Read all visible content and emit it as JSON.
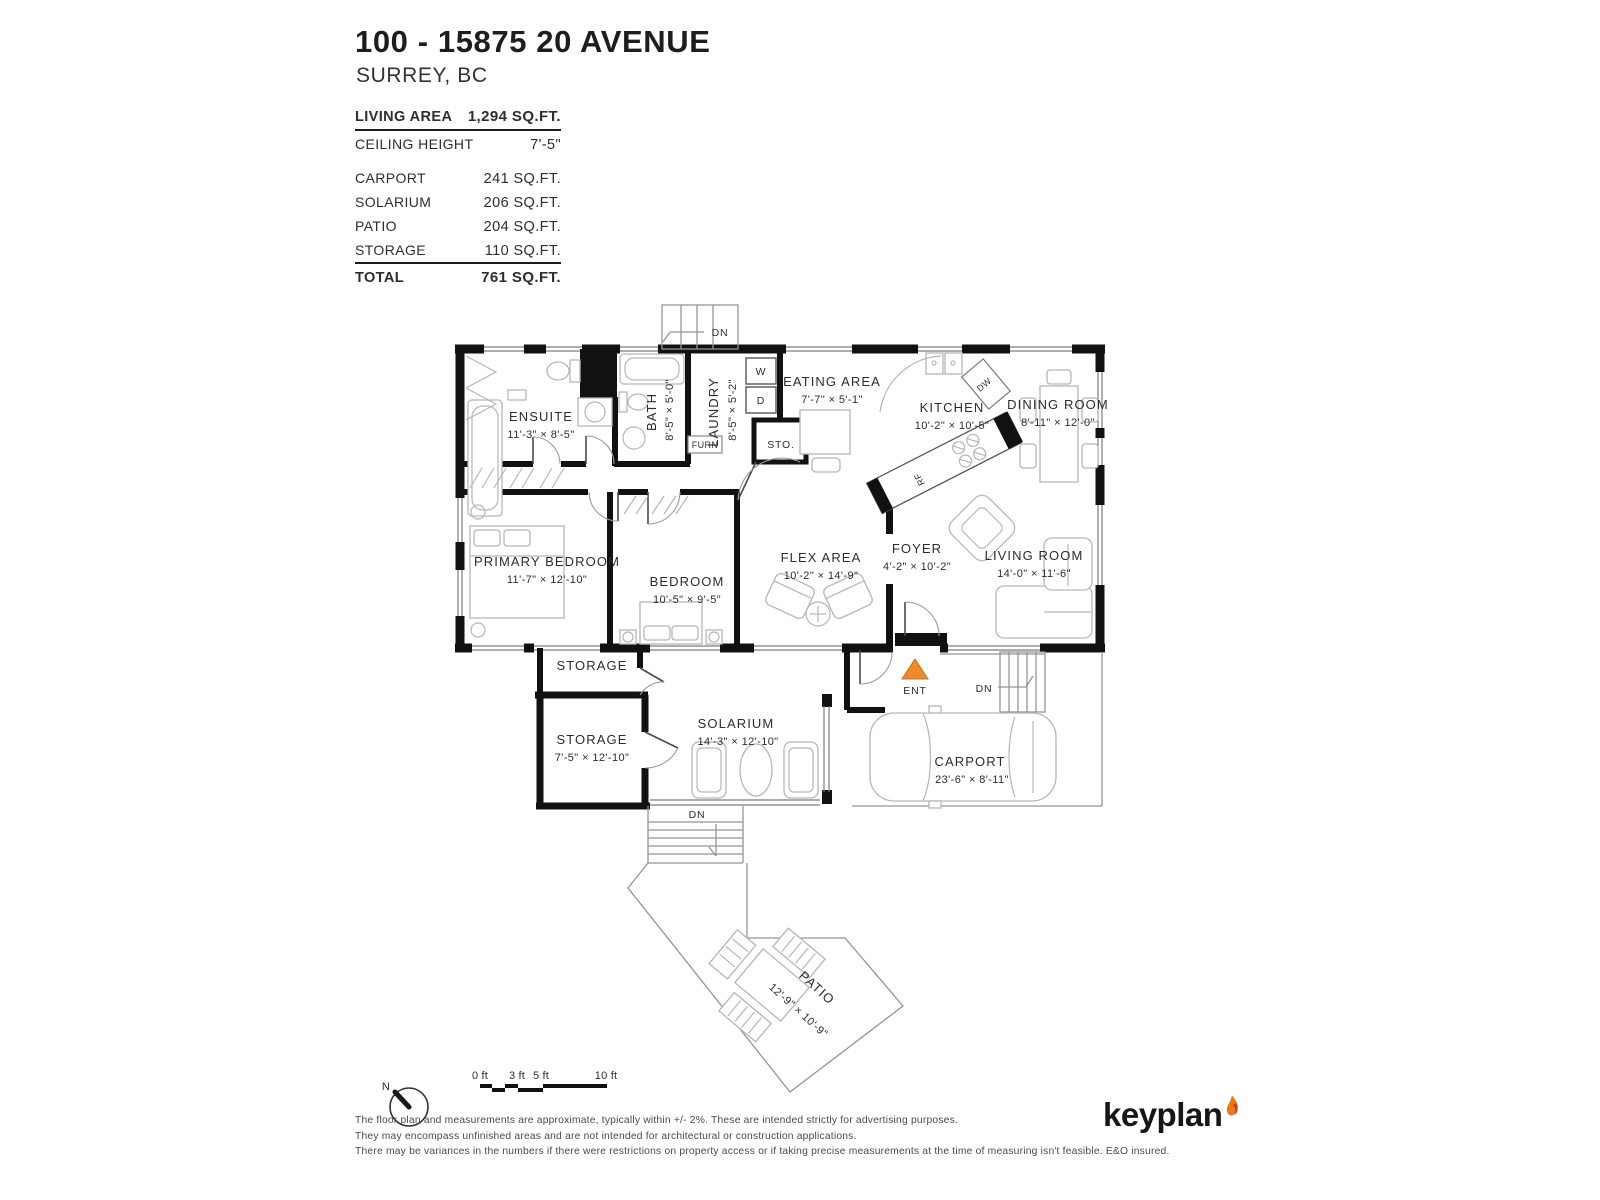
{
  "header": {
    "title": "100 - 15875 20 AVENUE",
    "subtitle": "SURREY, BC"
  },
  "stats": {
    "living_area": {
      "label": "LIVING AREA",
      "value": "1,294 SQ.FT."
    },
    "ceiling_height": {
      "label": "CEILING HEIGHT",
      "value": "7'-5\""
    },
    "areas": [
      {
        "label": "CARPORT",
        "value": "241 SQ.FT."
      },
      {
        "label": "SOLARIUM",
        "value": "206 SQ.FT."
      },
      {
        "label": "PATIO",
        "value": "204 SQ.FT."
      },
      {
        "label": "STORAGE",
        "value": "110 SQ.FT."
      }
    ],
    "total": {
      "label": "TOTAL",
      "value": "761 SQ.FT."
    }
  },
  "plan": {
    "rooms": {
      "ensuite": {
        "name": "ENSUITE",
        "dims": "11'-3\" × 8'-5\""
      },
      "bath": {
        "name": "BATH",
        "dims": "8'-5\" × 5'-0\""
      },
      "laundry": {
        "name": "LAUNDRY",
        "dims": "8'-5\" × 5'-2\""
      },
      "eating_area": {
        "name": "EATING AREA",
        "dims": "7'-7\" × 5'-1\""
      },
      "kitchen": {
        "name": "KITCHEN",
        "dims": "10'-2\" × 10'-5\""
      },
      "dining_room": {
        "name": "DINING ROOM",
        "dims": "8'-11\" × 12'-0\""
      },
      "primary_bedroom": {
        "name": "PRIMARY BEDROOM",
        "dims": "11'-7\" × 12'-10\""
      },
      "bedroom": {
        "name": "BEDROOM",
        "dims": "10'-5\" × 9'-5\""
      },
      "flex_area": {
        "name": "FLEX AREA",
        "dims": "10'-2\" × 14'-9\""
      },
      "foyer": {
        "name": "FOYER",
        "dims": "4'-2\" × 10'-2\""
      },
      "living_room": {
        "name": "LIVING ROOM",
        "dims": "14'-0\" × 11'-6\""
      },
      "storage_upper": {
        "name": "STORAGE"
      },
      "storage_lower": {
        "name": "STORAGE",
        "dims": "7'-5\" × 12'-10\""
      },
      "solarium": {
        "name": "SOLARIUM",
        "dims": "14'-3\" × 12'-10\""
      },
      "carport": {
        "name": "CARPORT",
        "dims": "23'-6\" × 8'-11\""
      },
      "patio": {
        "name": "PATIO",
        "dims": "12'-9\" × 10'-9\""
      }
    },
    "annotations": {
      "down": "DN",
      "entry": "ENT",
      "storage_closet": "STO.",
      "furnace": "FURN",
      "washer": "W",
      "dryer": "D",
      "dishwasher": "DW",
      "fridge": "RF"
    }
  },
  "scale_bar": {
    "ticks": [
      "0 ft",
      "3 ft",
      "5 ft",
      "10 ft"
    ]
  },
  "compass": {
    "north": "N"
  },
  "disclaimer": {
    "line1": "The floor plan and measurements are approximate, typically within +/- 2%. These are intended strictly for advertising purposes.",
    "line2": "They may encompass unfinished areas and are not intended for architectural or construction applications.",
    "line3": "There may be variances in the numbers if there were restrictions on property access or if taking precise measurements at the time of measuring isn't feasible. E&O insured."
  },
  "logo": {
    "text": "keyplan"
  },
  "colors": {
    "wall": "#111111",
    "accent_orange": "#ec8a2e",
    "flame_red": "#c23b1c"
  }
}
